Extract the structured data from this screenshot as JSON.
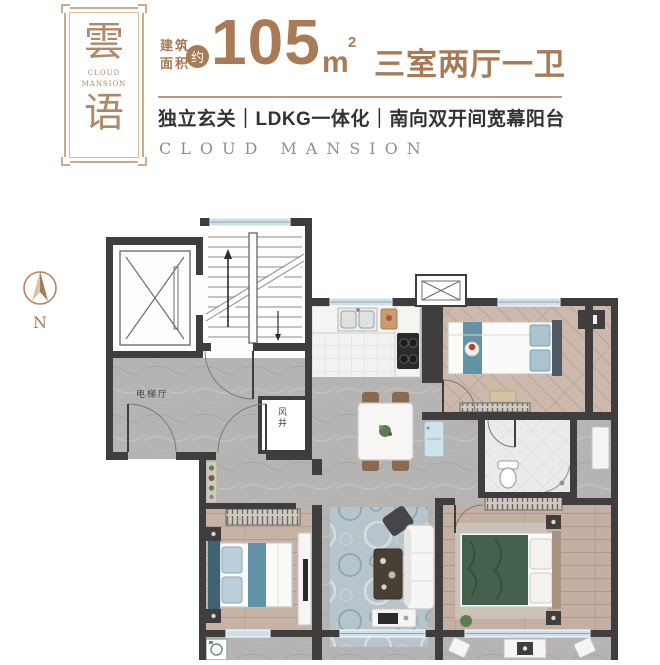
{
  "header": {
    "logo": {
      "char_top": "雲",
      "char_bottom": "语",
      "sub": "CLOUD MANSION"
    },
    "area": {
      "prefix_line1": "建筑",
      "prefix_line2": "面积",
      "approx": "约",
      "value": "105",
      "unit_base": "m",
      "unit_sup": "2"
    },
    "layout_title": "三室两厅一卫",
    "features": "独立玄关｜LDKG一体化｜南向双开间宽幕阳台",
    "english": "CLOUD MANSION"
  },
  "compass": {
    "north_label": "N"
  },
  "floorplan": {
    "labels": {
      "elevator_hall": "电梯厅",
      "air_shaft": "风井"
    },
    "colors": {
      "accent_brown": "#a87a56",
      "frame_brown": "#cdab8a",
      "wall": "#3f3d3e",
      "marble_floor": "#b6b4b2",
      "wood_floor": "#c6b3a5",
      "window_glass": "#cfdfe9",
      "teal_textile": "#6293a6",
      "master_bed_green": "#44614e",
      "rug_blue": "#b7c4cb"
    }
  }
}
